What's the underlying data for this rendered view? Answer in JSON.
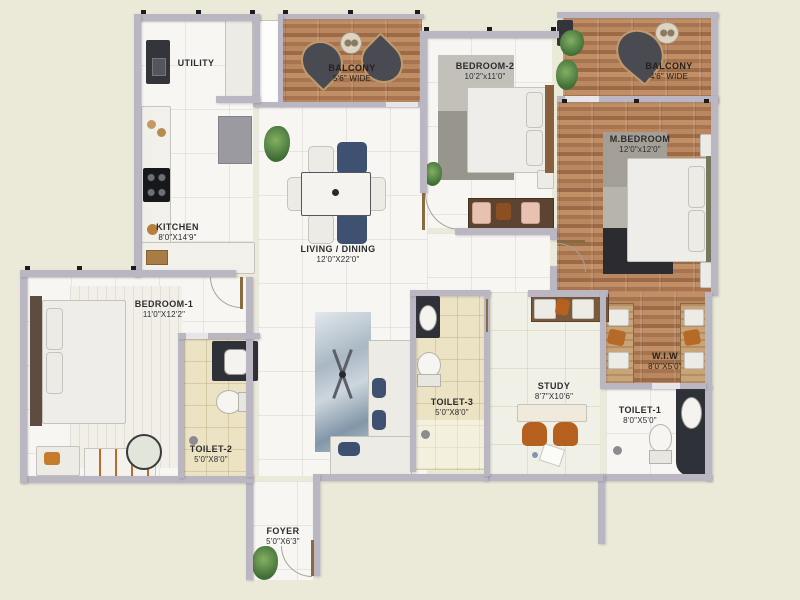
{
  "plan_title": "3 BHK Apartment Floor Plan",
  "rooms": {
    "utility": {
      "name": "UTILITY",
      "dims": ""
    },
    "kitchen": {
      "name": "KITCHEN",
      "dims": "8'0\"X14'9\""
    },
    "balcony1": {
      "name": "BALCONY",
      "dims": "5'6\" WIDE"
    },
    "bedroom2": {
      "name": "BEDROOM-2",
      "dims": "10'2\"x11'0\""
    },
    "balcony2": {
      "name": "BALCONY",
      "dims": "4'6\" WIDE"
    },
    "mbedroom": {
      "name": "M.BEDROOM",
      "dims": "12'0\"x12'0\""
    },
    "living": {
      "name": "LIVING / DINING",
      "dims": "12'0\"X22'0\""
    },
    "bedroom1": {
      "name": "BEDROOM-1",
      "dims": "11'0\"X12'2\""
    },
    "toilet2": {
      "name": "TOILET-2",
      "dims": "5'0\"X8'0\""
    },
    "toilet3": {
      "name": "TOILET-3",
      "dims": "5'0\"X8'0\""
    },
    "study": {
      "name": "STUDY",
      "dims": "8'7\"X10'6\""
    },
    "wiw": {
      "name": "W.I.W",
      "dims": "8'0\"X5'0\""
    },
    "toilet1": {
      "name": "TOILET-1",
      "dims": "8'0\"X5'0\""
    },
    "foyer": {
      "name": "FOYER",
      "dims": "5'0\"X6'3\""
    }
  },
  "palette": {
    "background": "#ebe9d8",
    "wall": "#bab6c2",
    "wood": "#b2805a",
    "bath_floor": "#ece3c4",
    "navy_accent": "#3e5170",
    "orange_accent": "#b5601f",
    "label_text": "#2c2c30"
  }
}
